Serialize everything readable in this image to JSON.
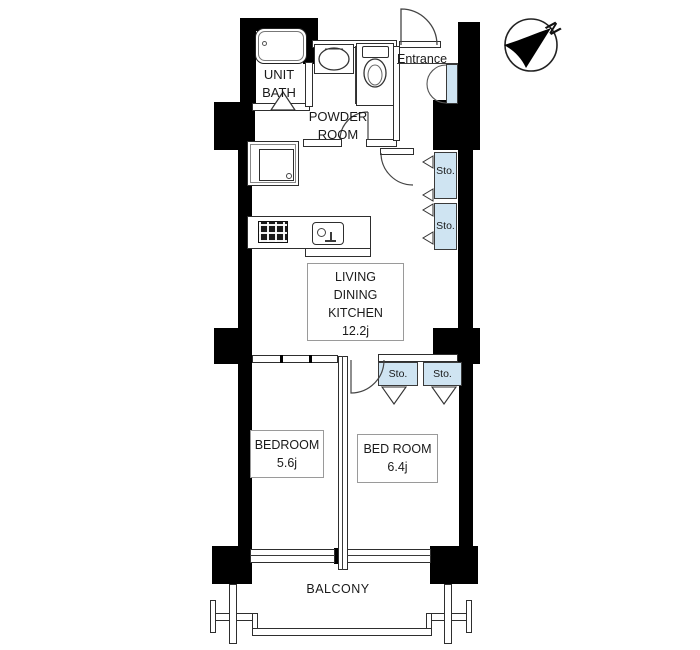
{
  "rooms": {
    "unit_bath": {
      "lines": [
        "UNIT",
        "BATH"
      ]
    },
    "powder_room": {
      "lines": [
        "POWDER",
        "ROOM"
      ]
    },
    "entrance": {
      "label": "Entrance"
    },
    "living_dining_kitchen": {
      "lines": [
        "LIVING",
        "DINING",
        "KITCHEN"
      ],
      "size": "12.2j"
    },
    "bedroom_left": {
      "label": "BEDROOM",
      "size": "5.6j"
    },
    "bedroom_right": {
      "label": "BED ROOM",
      "size": "6.4j"
    },
    "balcony": {
      "label": "BALCONY"
    }
  },
  "storages": {
    "labels": [
      "Sto.",
      "Sto.",
      "Sto.",
      "Sto."
    ]
  },
  "compass": {
    "label": "N"
  },
  "colors": {
    "wall": "#000000",
    "storage_fill": "#cfe4f2",
    "outline": "#2e2e2e",
    "background": "#ffffff"
  }
}
